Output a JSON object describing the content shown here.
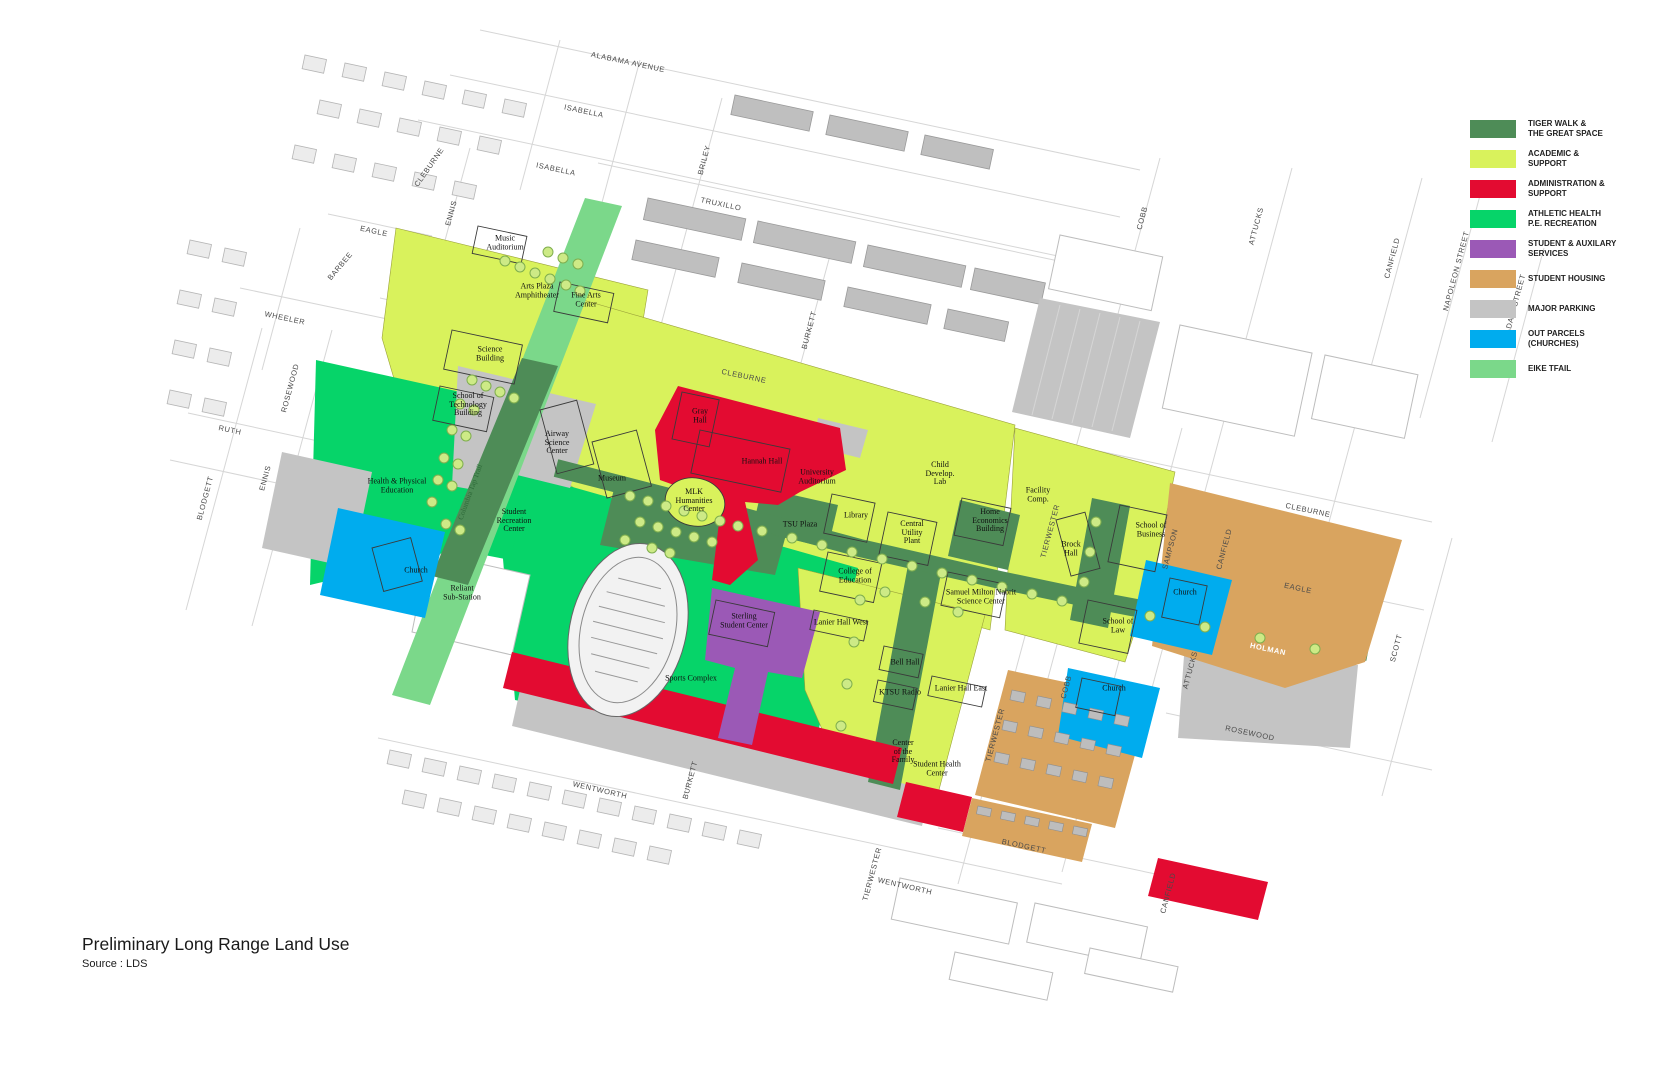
{
  "page": {
    "title": "Preliminary Long Range Land Use",
    "source": "Source : LDS"
  },
  "legend": {
    "items": [
      {
        "label": "TIGER WALK &\nTHE GREAT SPACE",
        "color": "#4E8C57"
      },
      {
        "label": "ACADEMIC &\nSUPPORT",
        "color": "#D9F25C"
      },
      {
        "label": "ADMINISTRATION &\nSUPPORT",
        "color": "#E30B31"
      },
      {
        "label": "ATHLETIC HEALTH\nP.E. RECREATION",
        "color": "#06D469"
      },
      {
        "label": "STUDENT & AUXILARY\nSERVICES",
        "color": "#9B59B6"
      },
      {
        "label": "STUDENT HOUSING",
        "color": "#D9A45F"
      },
      {
        "label": "MAJOR PARKING",
        "color": "#C4C4C4"
      },
      {
        "label": "OUT PARCELS\n(CHURCHES)",
        "color": "#00ACEE"
      },
      {
        "label": "EIKE TFAIL",
        "color": "#7BD88A"
      }
    ]
  },
  "map": {
    "trail_label": "Columbia Tap Trail",
    "buildings": [
      {
        "label": "Music\nAuditorium"
      },
      {
        "label": "Arts Plaza\nAmphitheater"
      },
      {
        "label": "Fine Arts\nCenter"
      },
      {
        "label": "Science\nBuilding"
      },
      {
        "label": "School of\nTechnology\nBuilding"
      },
      {
        "label": "Airway\nScience\nCenter"
      },
      {
        "label": "Museum"
      },
      {
        "label": "Gray\nHall"
      },
      {
        "label": "Hannah Hall"
      },
      {
        "label": "University\nAuditorium"
      },
      {
        "label": "MLK\nHumanities\nCenter"
      },
      {
        "label": "TSU Plaza"
      },
      {
        "label": "Library"
      },
      {
        "label": "Central\nUtility\nPlant"
      },
      {
        "label": "Child\nDevelop.\nLab"
      },
      {
        "label": "Home\nEconomics\nBuilding"
      },
      {
        "label": "College of\nEducation"
      },
      {
        "label": "Samuel Milton Nabrit\nScience Center"
      },
      {
        "label": "Facility\nComp."
      },
      {
        "label": "Brock\nHall"
      },
      {
        "label": "School of\nBusiness"
      },
      {
        "label": "School of\nLaw"
      },
      {
        "label": "Health & Physical\nEducation"
      },
      {
        "label": "Student\nRecreation\nCenter"
      },
      {
        "label": "Church"
      },
      {
        "label": "Reliant\nSub-Station"
      },
      {
        "label": "Sterling\nStudent Center"
      },
      {
        "label": "Sports Complex"
      },
      {
        "label": "Lanier Hall West"
      },
      {
        "label": "Bell Hall"
      },
      {
        "label": "KTSU Radio"
      },
      {
        "label": "Lanier Hall East"
      },
      {
        "label": "Center\nof the\nFamily"
      },
      {
        "label": "Student Health\nCenter"
      },
      {
        "label": "Church"
      },
      {
        "label": "Church"
      }
    ],
    "streets": [
      {
        "label": "ALABAMA AVENUE"
      },
      {
        "label": "ISABELLA"
      },
      {
        "label": "ISABELLA"
      },
      {
        "label": "TRUXILLO"
      },
      {
        "label": "CLEBURNE"
      },
      {
        "label": "BRILEY"
      },
      {
        "label": "BURKETT"
      },
      {
        "label": "CLEBURNE"
      },
      {
        "label": "EAGLE"
      },
      {
        "label": "BARBEE"
      },
      {
        "label": "WHEELER"
      },
      {
        "label": "ROSEWOOD"
      },
      {
        "label": "RUTH"
      },
      {
        "label": "ENNIS"
      },
      {
        "label": "BLODGETT"
      },
      {
        "label": "ENNIS"
      },
      {
        "label": "COBB"
      },
      {
        "label": "ATTUCKS"
      },
      {
        "label": "CANFIELD"
      },
      {
        "label": "NAPOLEON STREET"
      },
      {
        "label": "ADAIR STREET"
      },
      {
        "label": "CLEBURNE"
      },
      {
        "label": "CANFIELD"
      },
      {
        "label": "EAGLE"
      },
      {
        "label": "SCOTT"
      },
      {
        "label": "ATTUCKS"
      },
      {
        "label": "COBB"
      },
      {
        "label": "ROSEWOOD"
      },
      {
        "label": "HOLMAN"
      },
      {
        "label": "WENTWORTH"
      },
      {
        "label": "BURKETT"
      },
      {
        "label": "WENTWORTH"
      },
      {
        "label": "TIERWESTER"
      },
      {
        "label": "BLODGETT"
      },
      {
        "label": "CANFIELD"
      },
      {
        "label": "TIERWESTER"
      },
      {
        "label": "SAMPSON"
      },
      {
        "label": "TIERWESTER"
      }
    ]
  }
}
